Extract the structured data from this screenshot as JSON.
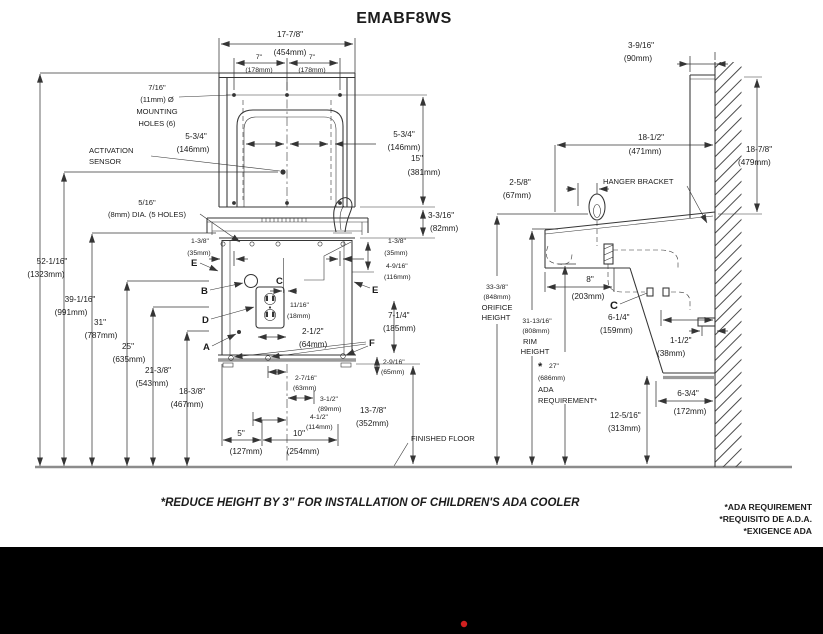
{
  "title": "EMABF8WS",
  "footer": {
    "note": "*REDUCE HEIGHT BY 3\" FOR INSTALLATION OF CHILDREN'S ADA COOLER",
    "ada_notes": [
      "*ADA REQUIREMENT",
      "*REQUISITO DE A.D.A.",
      "*EXIGENCE ADA"
    ]
  },
  "fv": {
    "w_in": "17-7/8\"",
    "w_mm": "(454mm)",
    "sp_l_in": "7\"",
    "sp_l_mm": "(178mm)",
    "sp_r_in": "7\"",
    "sp_r_mm": "(178mm)",
    "mh1": "7/16\"",
    "mh2": "(11mm) Ø",
    "mh3": "MOUNTING",
    "mh4": "HOLES (6)",
    "act1": "ACTIVATION",
    "act2": "SENSOR",
    "s_l_in": "5-3/4\"",
    "s_l_mm": "(146mm)",
    "s_r_in": "5-3/4\"",
    "s_r_mm": "(146mm)",
    "h15_in": "15\"",
    "h15_mm": "(381mm)",
    "fh1": "5/16\"",
    "fh2": "(8mm) DIA. (5 HOLES)",
    "d82_in": "3-3/16\"",
    "d82_mm": "(82mm)",
    "e_l_in": "1-3/8\"",
    "e_l_mm": "(35mm)",
    "e_r_in": "1-3/8\"",
    "e_r_mm": "(35mm)",
    "d116_in": "4-9/16\"",
    "d116_mm": "(116mm)",
    "d18_in": "11/16\"",
    "d18_mm": "(18mm)",
    "d64_in": "2-1/2\"",
    "d64_mm": "(64mm)",
    "d185_in": "7-1/4\"",
    "d185_mm": "(185mm)",
    "d65_in": "2-9/16\"",
    "d65_mm": "(65mm)",
    "d63_in": "2-7/16\"",
    "d63_mm": "(63mm)",
    "d89_in": "3-1/2\"",
    "d89_mm": "(89mm)",
    "d114_in": "4-1/2\"",
    "d114_mm": "(114mm)",
    "d127_in": "5\"",
    "d127_mm": "(127mm)",
    "d254_in": "10\"",
    "d254_mm": "(254mm)",
    "d352_in": "13-7/8\"",
    "d352_mm": "(352mm)",
    "ff": "FINISHED FLOOR",
    "heights": [
      {
        "in": "52-1/16\"",
        "mm": "(1323mm)"
      },
      {
        "in": "39-1/16\"",
        "mm": "(991mm)"
      },
      {
        "in": "31\"",
        "mm": "(787mm)"
      },
      {
        "in": "25\"",
        "mm": "(635mm)"
      },
      {
        "in": "21-3/8\"",
        "mm": "(543mm)"
      },
      {
        "in": "18-3/8\"",
        "mm": "(467mm)"
      }
    ],
    "A": "A",
    "B": "B",
    "C": "C",
    "D": "D",
    "E": "E",
    "F": "F"
  },
  "sv": {
    "d90_in": "3-9/16\"",
    "d90_mm": "(90mm)",
    "d471_in": "18-1/2\"",
    "d471_mm": "(471mm)",
    "d479_in": "18-7/8\"",
    "d479_mm": "(479mm)",
    "d67_in": "2-5/8\"",
    "d67_mm": "(67mm)",
    "hanger": "HANGER BRACKET",
    "orifice": {
      "in": "33-3/8\"",
      "mm": "(848mm)",
      "l3": "ORIFICE",
      "l4": "HEIGHT"
    },
    "rim": {
      "in": "31-13/16\"",
      "mm": "(808mm)",
      "l3": "RIM",
      "l4": "HEIGHT"
    },
    "ada": {
      "star": "*",
      "in": "27\"",
      "mm": "(686mm)",
      "l3": "ADA",
      "l4": "REQUIREMENT*"
    },
    "d203_in": "8\"",
    "d203_mm": "(203mm)",
    "d159_in": "6-1/4\"",
    "d159_mm": "(159mm)",
    "d38_in": "1-1/2\"",
    "d38_mm": "(38mm)",
    "d172_in": "6-3/4\"",
    "d172_mm": "(172mm)",
    "d313_in": "12-5/16\"",
    "d313_mm": "(313mm)",
    "C": "C"
  },
  "colors": {
    "line": "#353535",
    "floor_gray": "#9a9a9a",
    "band": "#000000",
    "red_dot": "#d1201f"
  }
}
